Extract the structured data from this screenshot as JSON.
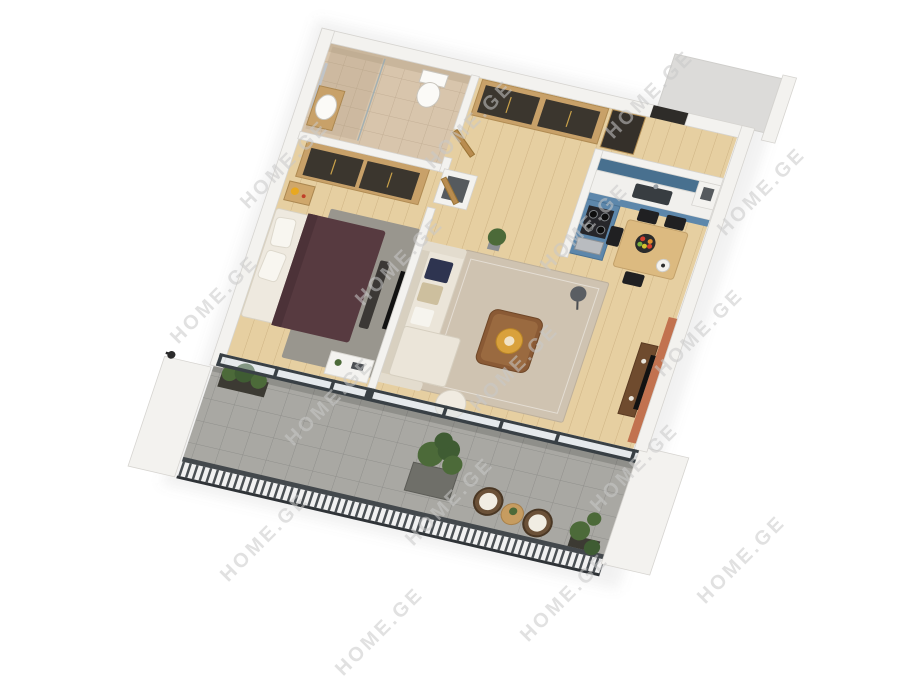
{
  "watermark": {
    "text": "HOME.GE",
    "color": "rgba(200,200,200,0.55)",
    "positions": [
      [
        285,
        165
      ],
      [
        470,
        125
      ],
      [
        650,
        95
      ],
      [
        215,
        300
      ],
      [
        400,
        262
      ],
      [
        585,
        228
      ],
      [
        762,
        192
      ],
      [
        330,
        402
      ],
      [
        515,
        368
      ],
      [
        700,
        333
      ],
      [
        265,
        538
      ],
      [
        450,
        502
      ],
      [
        635,
        468
      ],
      [
        380,
        632
      ],
      [
        565,
        598
      ],
      [
        742,
        560
      ]
    ]
  },
  "colors": {
    "wall": "#f3f2ef",
    "wallEdge": "#d6d4d0",
    "woodFloor": "#e6cfa1",
    "woodLine": "rgba(160,125,75,0.35)",
    "bathFloor": "#d8c5ac",
    "bathLine": "rgba(150,125,100,0.3)",
    "bathWall": "#c9b69c",
    "balconyFloor": "#a9a8a3",
    "balconyLine": "rgba(80,80,78,0.28)",
    "cabinetBlue": "#5d87ab",
    "cabinetBlueDark": "#48708f",
    "counter": "#f1f0ed",
    "sink": "#383d41",
    "wardrobeWood": "#c8a169",
    "wardrobeDoor": "#3b362e",
    "handleGold": "#caa24a",
    "doorWood": "#b98c4f",
    "bedDuvet": "#573a40",
    "bedLinen": "#eee9df",
    "rugBedroom": "#99968e",
    "rugLiving": "#cfc3b1",
    "sofa": "#ebe5d9",
    "sofaBack": "#d8d0c0",
    "cushionNavy": "#2e3450",
    "cushionTan": "#cdbf9e",
    "coffeeTable": "#8a5a35",
    "trayGold": "#d9a13c",
    "tvWall": "#c2724f",
    "tvConsole": "#6f4b2e",
    "tvBlack": "#121212",
    "diningTable": "#dcba80",
    "chairBlack": "#202022",
    "railing": "#43484c",
    "railingBar": "#4b5054",
    "plantGreen": "#4c6a39",
    "plantDark": "#3f5c33",
    "planterBox": "#3c3a33",
    "stove": "#26262a",
    "shaftDark": "#565a5e",
    "exteriorGray": "#dcdbd9",
    "watermarkColor": "rgba(200,200,200,0.55)"
  }
}
